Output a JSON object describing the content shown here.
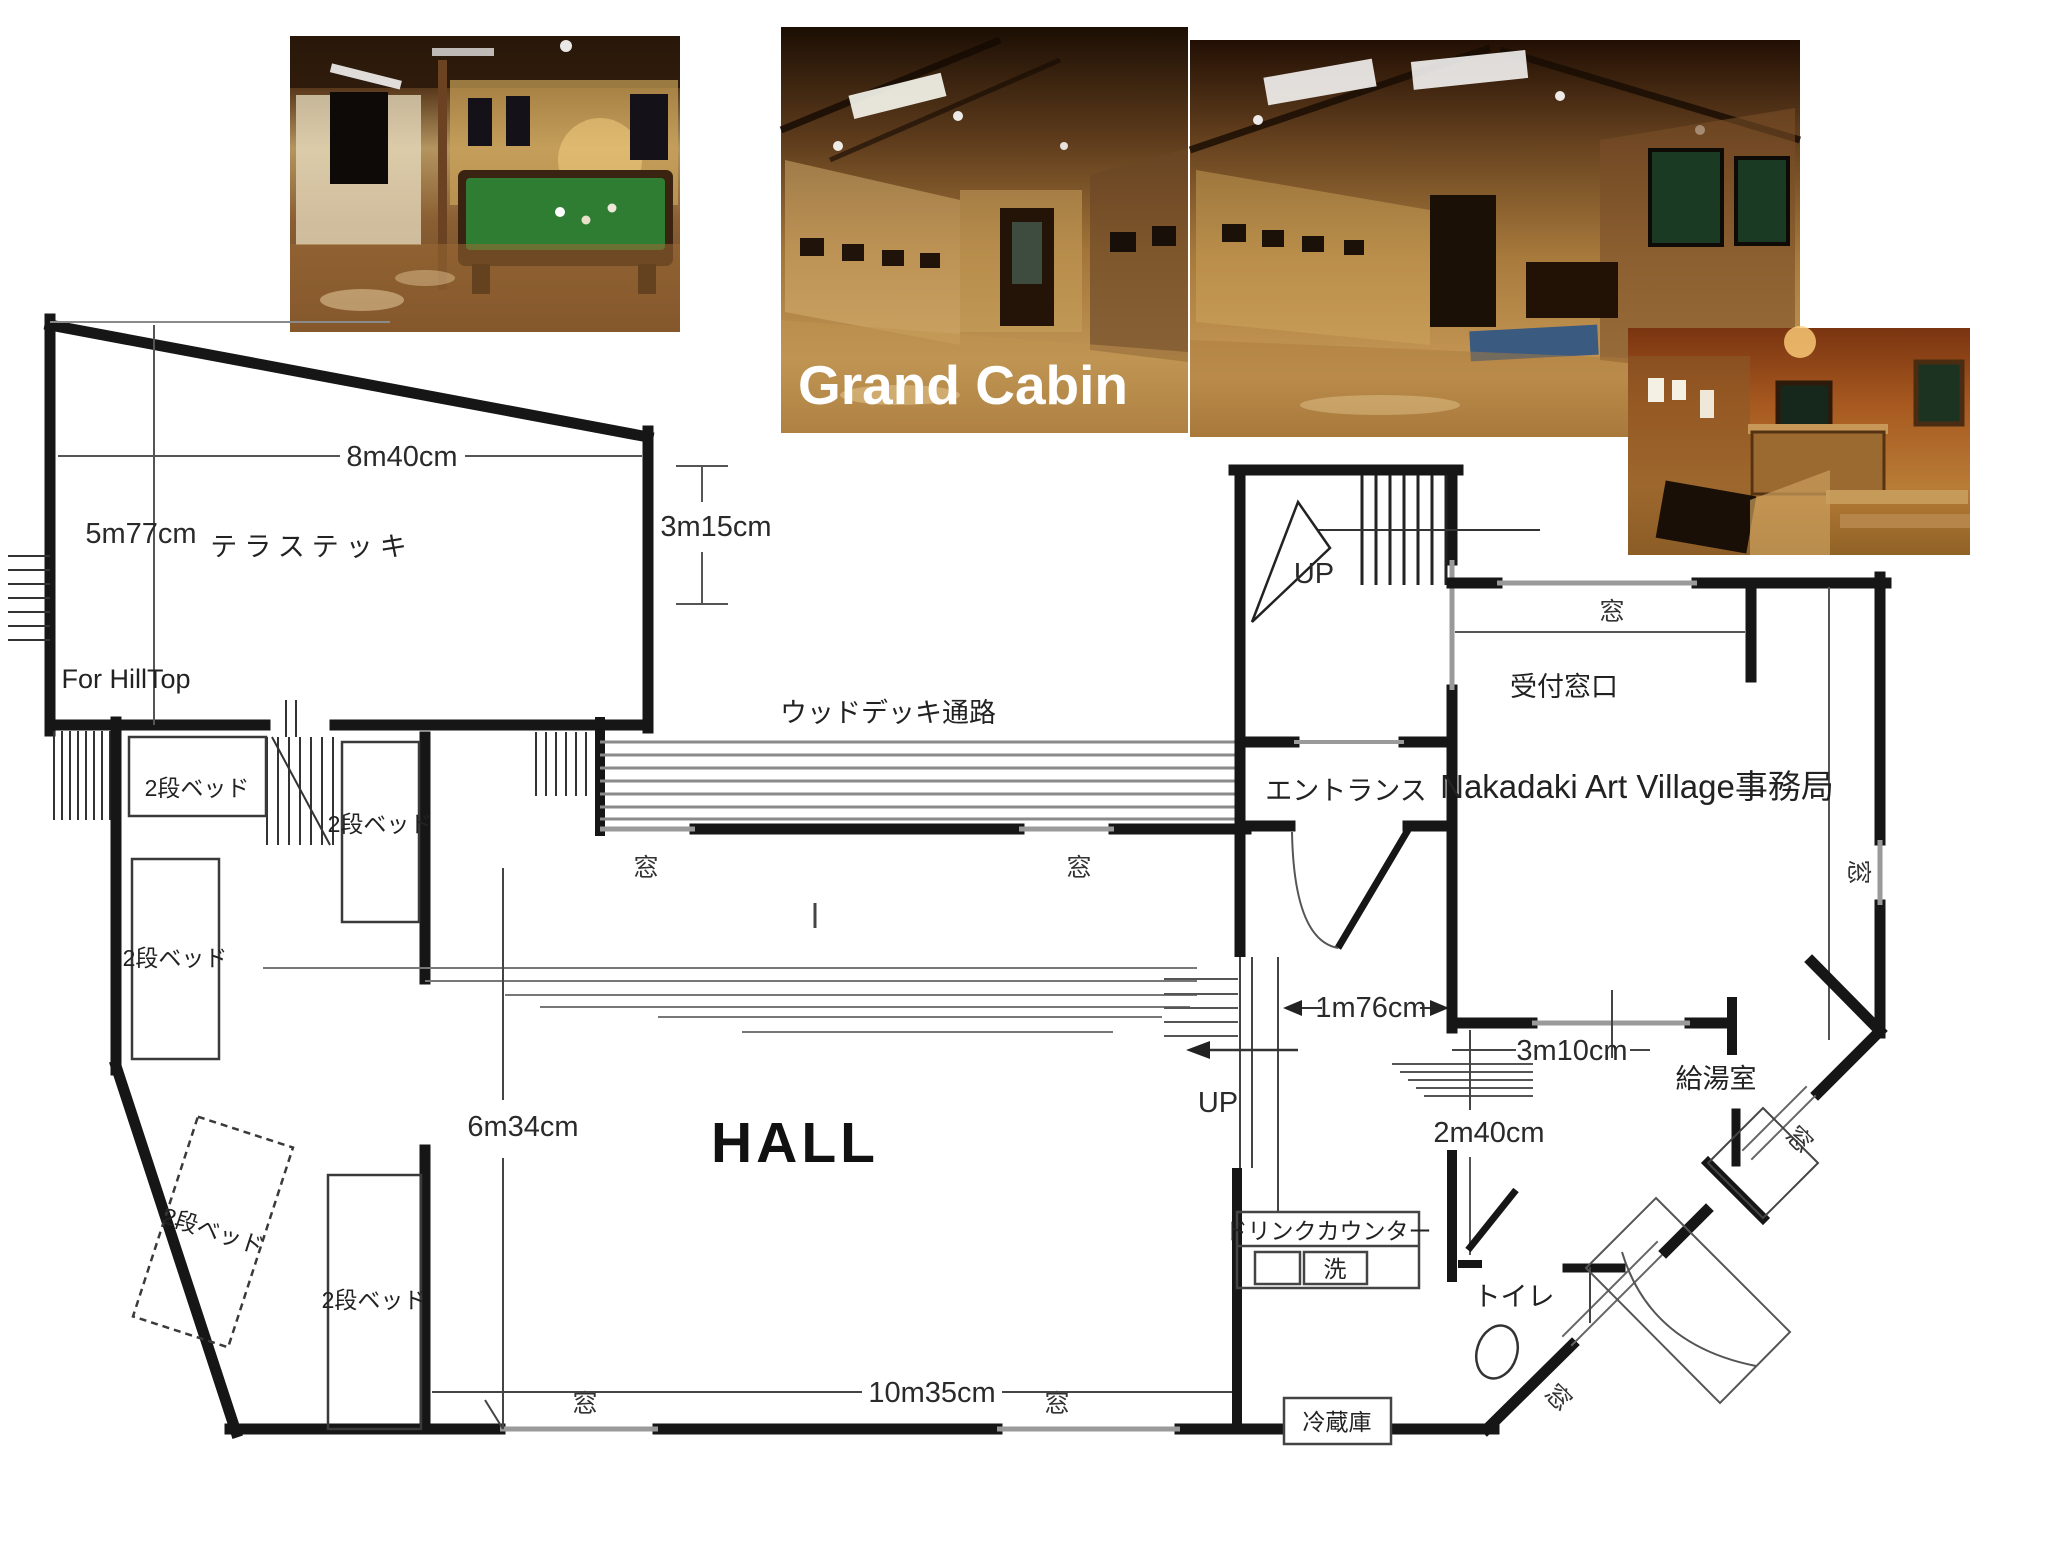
{
  "photos": {
    "grand_cabin_caption": "Grand Cabin"
  },
  "plan": {
    "terrace": {
      "label": "テラステッキ",
      "width": "8m40cm",
      "left_height": "5m77cm",
      "right_height": "3m15cm",
      "hilltop": "For HillTop"
    },
    "deck": {
      "label": "ウッドデッキ通路"
    },
    "hall": {
      "label": "HALL",
      "width": "10m35cm",
      "depth": "6m34cm"
    },
    "labels": {
      "window": "窓",
      "bunk_bed": "2段ベッド",
      "up": "UP"
    },
    "entrance": {
      "label": "エントランス",
      "width": "1m76cm"
    },
    "office": {
      "label": "Nakadaki Art Village事務局",
      "reception": "受付窓口"
    },
    "steps": {
      "width": "3m10cm",
      "depth": "2m40cm"
    },
    "rooms": {
      "kitchen": "給湯室",
      "toilet": "トイレ",
      "fridge": "冷蔵庫",
      "drink_counter": "ドリンクカウンター",
      "wash": "洗"
    }
  },
  "colors": {
    "wall": "#161616",
    "window_line": "#9a9a9a",
    "pool_table": "#2f7d32",
    "wood_dark": "#241408",
    "wood_mid": "#7a4f26",
    "wood_light": "#b98a50"
  }
}
